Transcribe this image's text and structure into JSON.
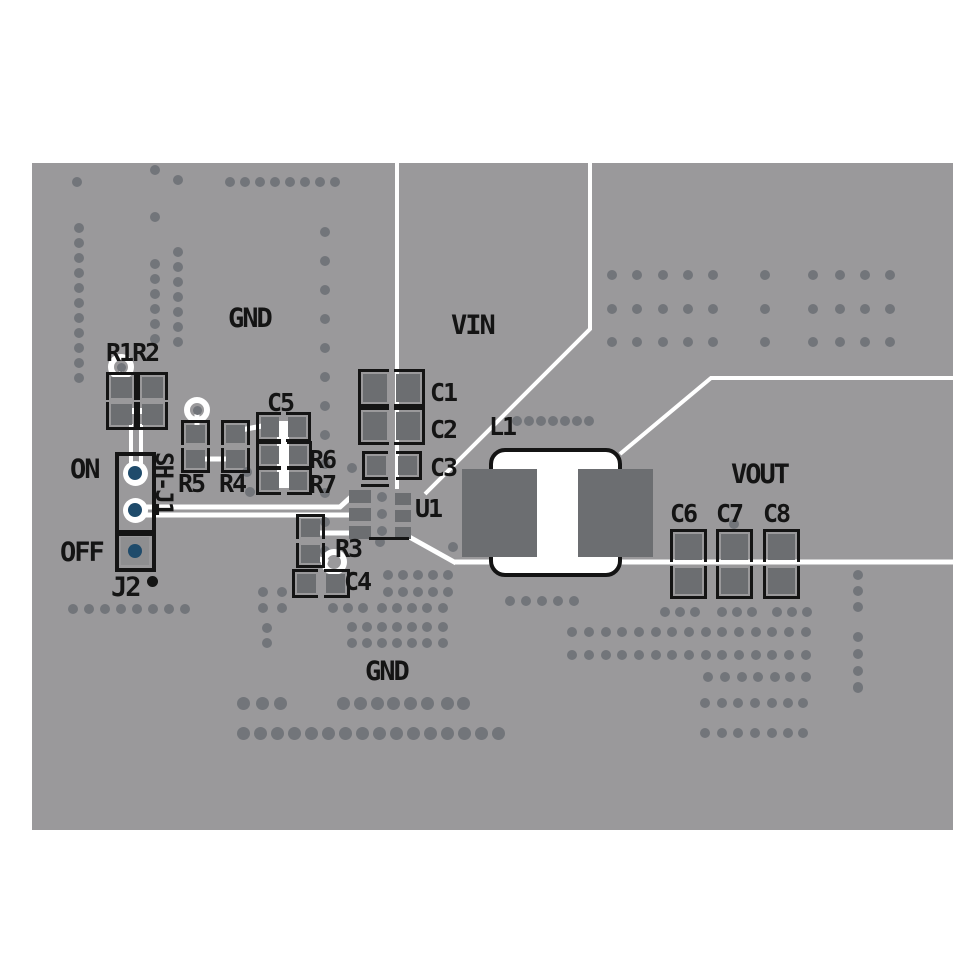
{
  "meta": {
    "description": "PCB evaluation board top layer layout",
    "canvas_w": 971,
    "canvas_h": 971
  },
  "colors": {
    "background": "#ffffff",
    "board": "#9a999b",
    "via": "#72757a",
    "pad": "#6c6e71",
    "pad_light": "#8e8e90",
    "silk": "#141414",
    "trace": "#ffffff",
    "hole_blue": "#1f4b6b"
  },
  "board": {
    "x": 32,
    "y": 163,
    "w": 921,
    "h": 667
  },
  "labels": [
    {
      "id": "gnd-top",
      "text": "GND",
      "x": 228,
      "y": 305,
      "s": 27
    },
    {
      "id": "vin",
      "text": "VIN",
      "x": 451,
      "y": 312,
      "s": 27
    },
    {
      "id": "vout",
      "text": "VOUT",
      "x": 731,
      "y": 461,
      "s": 27
    },
    {
      "id": "gnd-bottom",
      "text": "GND",
      "x": 365,
      "y": 658,
      "s": 27
    },
    {
      "id": "r1r2",
      "text": "R1R2",
      "x": 106,
      "y": 340,
      "s": 25
    },
    {
      "id": "c5",
      "text": "C5",
      "x": 267,
      "y": 390,
      "s": 25
    },
    {
      "id": "r5",
      "text": "R5",
      "x": 178,
      "y": 471,
      "s": 25
    },
    {
      "id": "r4",
      "text": "R4",
      "x": 219,
      "y": 471,
      "s": 25
    },
    {
      "id": "r6",
      "text": "R6",
      "x": 309,
      "y": 447,
      "s": 25
    },
    {
      "id": "r7",
      "text": "R7",
      "x": 309,
      "y": 472,
      "s": 25
    },
    {
      "id": "c1",
      "text": "C1",
      "x": 430,
      "y": 380,
      "s": 25
    },
    {
      "id": "c2",
      "text": "C2",
      "x": 430,
      "y": 417,
      "s": 25
    },
    {
      "id": "c3",
      "text": "C3",
      "x": 430,
      "y": 455,
      "s": 25
    },
    {
      "id": "l1",
      "text": "L1",
      "x": 489,
      "y": 414,
      "s": 25
    },
    {
      "id": "u1",
      "text": "U1",
      "x": 415,
      "y": 496,
      "s": 25
    },
    {
      "id": "r3",
      "text": "R3",
      "x": 335,
      "y": 536,
      "s": 25
    },
    {
      "id": "c4",
      "text": "C4",
      "x": 344,
      "y": 569,
      "s": 25
    },
    {
      "id": "c6",
      "text": "C6",
      "x": 670,
      "y": 501,
      "s": 25
    },
    {
      "id": "c7",
      "text": "C7",
      "x": 716,
      "y": 501,
      "s": 25
    },
    {
      "id": "c8",
      "text": "C8",
      "x": 763,
      "y": 501,
      "s": 25
    },
    {
      "id": "on",
      "text": "ON",
      "x": 70,
      "y": 456,
      "s": 27
    },
    {
      "id": "off",
      "text": "OFF",
      "x": 60,
      "y": 539,
      "s": 27
    },
    {
      "id": "j2",
      "text": "J2",
      "x": 111,
      "y": 574,
      "s": 27
    },
    {
      "id": "sh-j1",
      "text": "SH-J1",
      "x": 176,
      "y": 452,
      "s": 24,
      "vert": true
    }
  ],
  "traces": [
    {
      "pts": [
        [
          397,
          163
        ],
        [
          397,
          489
        ]
      ],
      "w": 4
    },
    {
      "pts": [
        [
          590,
          163
        ],
        [
          590,
          329
        ],
        [
          425,
          494
        ]
      ],
      "w": 4
    },
    {
      "pts": [
        [
          620,
          454
        ],
        [
          711,
          378
        ],
        [
          953,
          378
        ]
      ],
      "w": 4
    },
    {
      "pts": [
        [
          455,
          562
        ],
        [
          953,
          562
        ]
      ],
      "w": 5
    },
    {
      "pts": [
        [
          404,
          534
        ],
        [
          456,
          563
        ]
      ],
      "w": 5
    },
    {
      "pts": [
        [
          131,
          424
        ],
        [
          131,
          464
        ]
      ],
      "w": 4
    },
    {
      "pts": [
        [
          141,
          424
        ],
        [
          141,
          464
        ]
      ],
      "w": 4
    },
    {
      "pts": [
        [
          129,
          411
        ],
        [
          144,
          411
        ]
      ],
      "w": 6
    },
    {
      "pts": [
        [
          143,
          507
        ],
        [
          340,
          507
        ],
        [
          352,
          496
        ]
      ],
      "w": 5
    },
    {
      "pts": [
        [
          143,
          515
        ],
        [
          352,
          515
        ]
      ],
      "w": 5
    },
    {
      "pts": [
        [
          311,
          521
        ],
        [
          311,
          533
        ],
        [
          353,
          533
        ]
      ],
      "w": 5
    },
    {
      "pts": [
        [
          197,
          411
        ],
        [
          197,
          429
        ]
      ],
      "w": 5
    },
    {
      "pts": [
        [
          195,
          459
        ],
        [
          236,
          459
        ]
      ],
      "w": 5
    },
    {
      "pts": [
        [
          236,
          431
        ],
        [
          262,
          426
        ]
      ],
      "w": 5
    },
    {
      "pts": [
        [
          283,
          421
        ],
        [
          283,
          488
        ]
      ],
      "w": 12
    },
    {
      "pts": [
        [
          311,
          556
        ],
        [
          328,
          562
        ]
      ],
      "w": 5
    },
    {
      "pts": [
        [
          121,
          371
        ],
        [
          121,
          379
        ]
      ],
      "w": 4
    }
  ],
  "test_rings": [
    {
      "c": [
        121,
        367
      ],
      "inner": true
    },
    {
      "c": [
        197,
        410
      ],
      "inner": true
    },
    {
      "c": [
        334,
        562
      ],
      "inner": false
    }
  ],
  "passives": [
    {
      "ref": "R1",
      "dir": "v",
      "p1": [
        111,
        377,
        21,
        21
      ],
      "p2": [
        111,
        404,
        21,
        21
      ]
    },
    {
      "ref": "R2",
      "dir": "v",
      "p1": [
        142,
        377,
        21,
        21
      ],
      "p2": [
        142,
        404,
        21,
        21
      ]
    },
    {
      "ref": "R5",
      "dir": "v",
      "p1": [
        186,
        425,
        19,
        18
      ],
      "p2": [
        186,
        450,
        19,
        18
      ]
    },
    {
      "ref": "R4",
      "dir": "v",
      "p1": [
        226,
        425,
        19,
        18
      ],
      "p2": [
        226,
        450,
        19,
        18
      ]
    },
    {
      "ref": "C5",
      "dir": "h",
      "p1": [
        261,
        417,
        18,
        20
      ],
      "p2": [
        288,
        417,
        18,
        20
      ]
    },
    {
      "ref": "R6",
      "dir": "h",
      "p1": [
        261,
        446,
        18,
        18
      ],
      "p2": [
        289,
        446,
        18,
        18
      ]
    },
    {
      "ref": "R7",
      "dir": "h",
      "p1": [
        261,
        472,
        18,
        18
      ],
      "p2": [
        289,
        472,
        18,
        18
      ]
    },
    {
      "ref": "R3",
      "dir": "v",
      "p1": [
        301,
        519,
        19,
        18
      ],
      "p2": [
        301,
        545,
        19,
        18
      ]
    },
    {
      "ref": "C4",
      "dir": "h",
      "p1": [
        297,
        574,
        19,
        19
      ],
      "p2": [
        326,
        574,
        19,
        19
      ]
    },
    {
      "ref": "C1",
      "dir": "h",
      "p1": [
        363,
        374,
        24,
        28
      ],
      "p2": [
        396,
        374,
        24,
        28
      ]
    },
    {
      "ref": "C2",
      "dir": "h",
      "p1": [
        363,
        412,
        24,
        28
      ],
      "p2": [
        396,
        412,
        24,
        28
      ]
    },
    {
      "ref": "C3",
      "dir": "h",
      "p1": [
        367,
        456,
        19,
        19
      ],
      "p2": [
        398,
        456,
        19,
        19
      ]
    },
    {
      "ref": "C6",
      "dir": "v",
      "p1": [
        675,
        534,
        27,
        26
      ],
      "p2": [
        675,
        568,
        27,
        26
      ]
    },
    {
      "ref": "C7",
      "dir": "v",
      "p1": [
        721,
        534,
        27,
        26
      ],
      "p2": [
        721,
        568,
        27,
        26
      ]
    },
    {
      "ref": "C8",
      "dir": "v",
      "p1": [
        768,
        534,
        27,
        26
      ],
      "p2": [
        768,
        568,
        27,
        26
      ]
    }
  ],
  "u1": {
    "left_pads": [
      [
        349,
        490
      ],
      [
        349,
        508
      ],
      [
        349,
        526
      ]
    ],
    "left_pad_w": 22,
    "left_pad_h": 13,
    "right_pads": [
      [
        395,
        493
      ],
      [
        395,
        510
      ],
      [
        395,
        527
      ]
    ],
    "right_pad_w": 16,
    "right_pad_h": 12,
    "silk_lines": [
      [
        361,
        484,
        28,
        3
      ],
      [
        369,
        537,
        40,
        3
      ]
    ]
  },
  "l1": {
    "outline": [
      489,
      448,
      133,
      129
    ],
    "outline_radius": 16,
    "outline_stroke": 4,
    "white_core": [
      493,
      452,
      125,
      121
    ],
    "pads": [
      [
        462,
        469,
        75,
        88
      ],
      [
        578,
        469,
        75,
        88
      ]
    ]
  },
  "jumper": {
    "rect_main": [
      115,
      452,
      41,
      82
    ],
    "rect_off": [
      115,
      532,
      41,
      40
    ],
    "pins_ring": [
      [
        135,
        473
      ],
      [
        135,
        510
      ]
    ],
    "pin_square": {
      "pad": [
        121,
        537,
        28,
        28
      ],
      "hole": [
        135,
        551
      ]
    },
    "ring_d": 25,
    "hole_d": 14,
    "silk_dot": [
      152,
      581
    ],
    "silk_dot_r": 5.5
  },
  "vias": {
    "r": 5,
    "singles": [
      [
        77,
        182
      ],
      [
        155,
        170
      ],
      [
        178,
        180
      ],
      [
        155,
        217
      ],
      [
        247,
        472
      ],
      [
        250,
        492
      ],
      [
        352,
        468
      ],
      [
        380,
        542
      ],
      [
        453,
        547
      ],
      [
        734,
        524
      ],
      [
        382,
        497
      ],
      [
        382,
        514
      ],
      [
        382,
        531
      ],
      [
        858,
        687
      ]
    ],
    "runs": [
      {
        "x": 230,
        "y": 182,
        "c": 8,
        "dx": 15,
        "dy": 0
      },
      {
        "x": 79,
        "y": 228,
        "c": 11,
        "dx": 0,
        "dy": 15
      },
      {
        "x": 155,
        "y": 264,
        "c": 6,
        "dx": 0,
        "dy": 15
      },
      {
        "x": 178,
        "y": 252,
        "c": 7,
        "dx": 0,
        "dy": 15
      },
      {
        "x": 325,
        "y": 232,
        "c": 12,
        "dx": 0,
        "dy": 29
      },
      {
        "x": 517,
        "y": 421,
        "c": 7,
        "dx": 12,
        "dy": 0
      },
      {
        "x": 510,
        "y": 601,
        "c": 5,
        "dx": 16,
        "dy": 0
      },
      {
        "x": 73,
        "y": 609,
        "c": 8,
        "dx": 16,
        "dy": 0
      },
      {
        "x": 243,
        "y": 733,
        "c": 16,
        "dx": 17,
        "dy": 0,
        "r": 6.5
      },
      {
        "x": 858,
        "y": 575,
        "c": 3,
        "dx": 0,
        "dy": 16
      },
      {
        "x": 858,
        "y": 637,
        "c": 4,
        "dx": 0,
        "dy": 17
      }
    ],
    "rows": [
      {
        "y": 275,
        "xs": [
          612,
          637,
          663,
          688,
          713,
          765,
          813,
          840,
          865,
          890
        ]
      },
      {
        "y": 309,
        "xs": [
          612,
          637,
          663,
          688,
          713,
          765,
          813,
          840,
          865,
          890
        ]
      },
      {
        "y": 342,
        "xs": [
          612,
          637,
          663,
          688,
          713,
          765,
          813,
          840,
          865,
          890
        ]
      },
      {
        "y": 575,
        "xs": [
          388,
          403,
          418,
          433,
          448
        ]
      },
      {
        "y": 592,
        "xs": [
          388,
          403,
          418,
          433,
          448
        ]
      },
      {
        "y": 608,
        "xs": [
          333,
          348,
          363,
          382,
          397,
          412,
          427,
          443
        ]
      },
      {
        "y": 627,
        "xs": [
          352,
          367,
          382,
          397,
          412,
          427,
          443
        ]
      },
      {
        "y": 643,
        "xs": [
          352,
          367,
          382,
          397,
          412,
          427,
          443
        ]
      },
      {
        "y": 592,
        "xs": [
          263,
          282
        ]
      },
      {
        "y": 608,
        "xs": [
          263,
          282
        ]
      },
      {
        "y": 628,
        "xs": [
          267
        ]
      },
      {
        "y": 643,
        "xs": [
          267
        ]
      },
      {
        "y": 612,
        "xs": [
          665,
          680,
          695,
          722,
          737,
          752,
          777,
          792,
          807
        ]
      },
      {
        "y": 632,
        "xs": [
          572,
          589,
          606,
          622,
          639,
          656,
          672,
          689,
          706,
          722,
          739,
          756,
          772,
          789,
          806
        ]
      },
      {
        "y": 655,
        "xs": [
          572,
          589,
          606,
          622,
          639,
          656,
          672,
          689,
          706,
          722,
          739,
          756,
          772,
          789,
          806
        ]
      },
      {
        "y": 677,
        "xs": [
          708,
          725,
          742,
          758,
          775,
          790,
          806
        ]
      },
      {
        "y": 703,
        "xs": [
          243,
          262,
          280,
          343,
          360,
          377,
          393,
          410,
          427,
          447,
          463
        ],
        "r": 6.5
      },
      {
        "y": 703,
        "xs": [
          705,
          722,
          738,
          755,
          772,
          788,
          803
        ]
      },
      {
        "y": 733,
        "xs": [
          705,
          722,
          738,
          755,
          772,
          788,
          803
        ]
      }
    ]
  }
}
